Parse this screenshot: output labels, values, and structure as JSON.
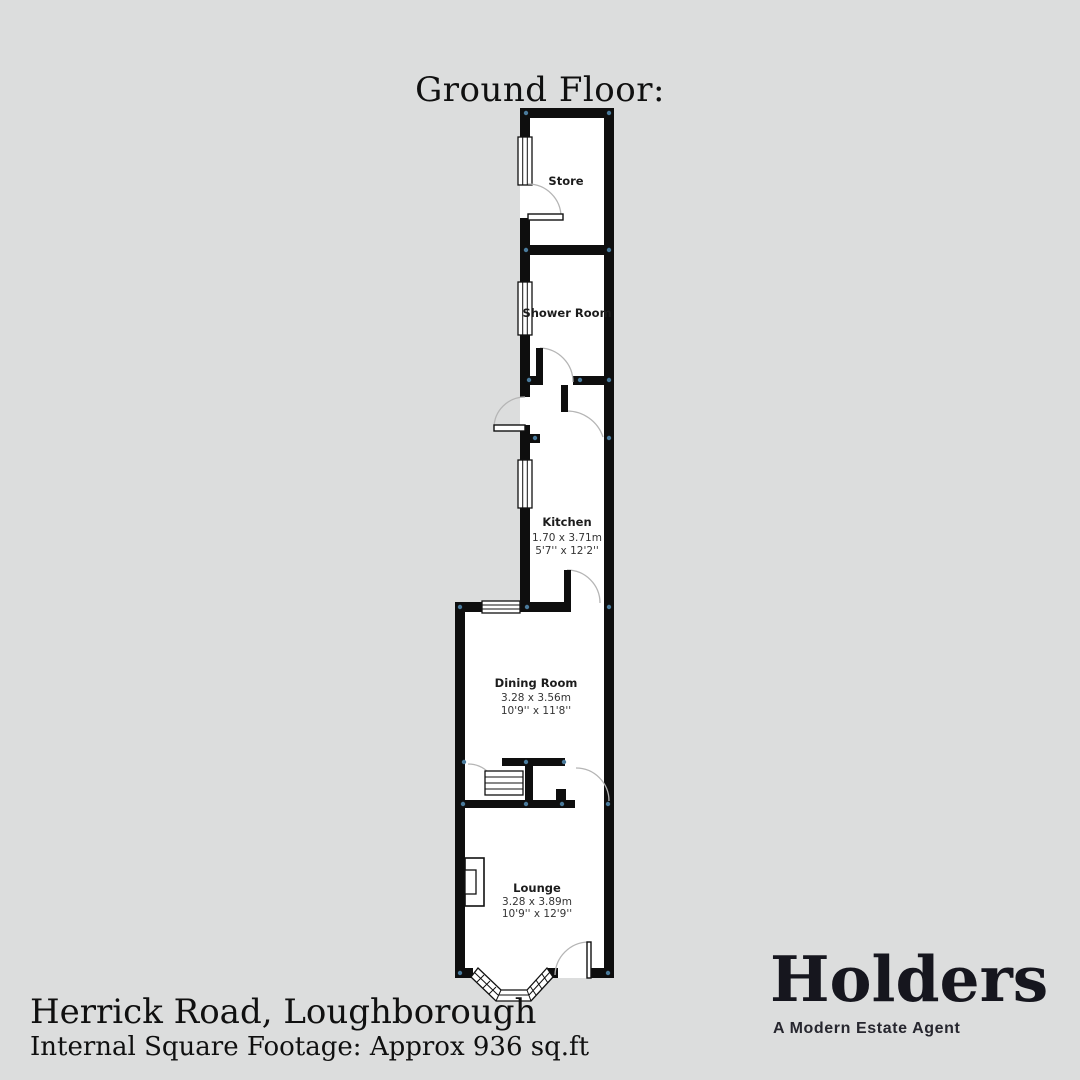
{
  "title": "Ground Floor:",
  "footer": {
    "address": "Herrick Road, Loughborough",
    "footage": "Internal Square Footage: Approx 936 sq.ft"
  },
  "brand": {
    "name": "Holders",
    "tagline": "A Modern Estate Agent"
  },
  "rooms": [
    {
      "name": "Store"
    },
    {
      "name": "Shower Room"
    },
    {
      "name": "Kitchen",
      "metric": "1.70 x 3.71m",
      "imperial": "5'7'' x 12'2''"
    },
    {
      "name": "Dining Room",
      "metric": "3.28 x 3.56m",
      "imperial": "10'9'' x 11'8''"
    },
    {
      "name": "Lounge",
      "metric": "3.28 x 3.89m",
      "imperial": "10'9'' x 12'9''"
    }
  ],
  "colors": {
    "background": "#dcdddd",
    "wall": "#0e0e0e",
    "floor": "#ffffff",
    "corner_dot": "#4a7a9b",
    "door_arc": "#b5b5b5",
    "brand_text": "#16161e"
  }
}
